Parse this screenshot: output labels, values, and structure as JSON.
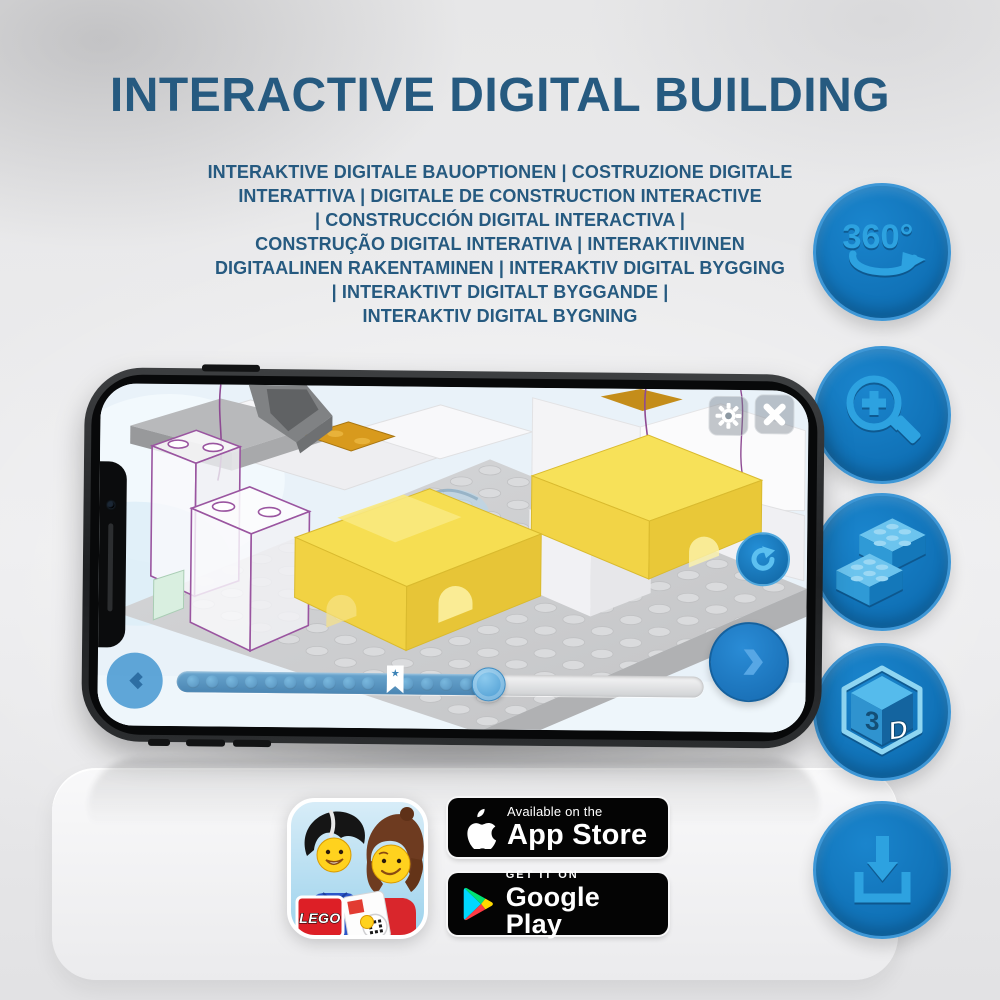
{
  "page": {
    "title": "INTERACTIVE DIGITAL BUILDING",
    "subtitle": "INTERAKTIVE DIGITALE BAUOPTIONEN | COSTRUZIONE DIGITALE\nINTERATTIVA | DIGITALE DE CONSTRUCTION INTERACTIVE\n| CONSTRUCCIÓN DIGITAL INTERACTIVA |\nCONSTRUÇÃO DIGITAL INTERATIVA | INTERAKTIIVINEN\nDIGITAALINEN RAKENTAMINEN | INTERAKTIV DIGITAL BYGGING\n| INTERAKTIVT DIGITALT BYGGANDE |\nINTERAKTIV DIGITAL BYGNING"
  },
  "feature_badges": {
    "rotate_360_label": "360°",
    "cube_letter_left": "3",
    "cube_letter_right": "D"
  },
  "phone": {
    "progress": {
      "star_icon": "★"
    }
  },
  "store": {
    "app_store": {
      "line1": "Available on the",
      "line2": "App Store"
    },
    "google_play": {
      "line1": "GET IT ON",
      "line2": "Google Play"
    }
  },
  "app_icon": {
    "lego_logo": "LEGO"
  },
  "colors": {
    "title_blue": "#265a80",
    "feature_circle_blue": "#1173b9",
    "feature_glyph_blue": "#2da2e0",
    "app_accent_blue": "#1e7ecb",
    "brick_yellow": "#f4d94d",
    "store_badge_black": "#040404",
    "play_cyan": "#00d7fe",
    "play_green": "#00e273",
    "play_yellow": "#ffd900",
    "play_red": "#ff3a44"
  }
}
